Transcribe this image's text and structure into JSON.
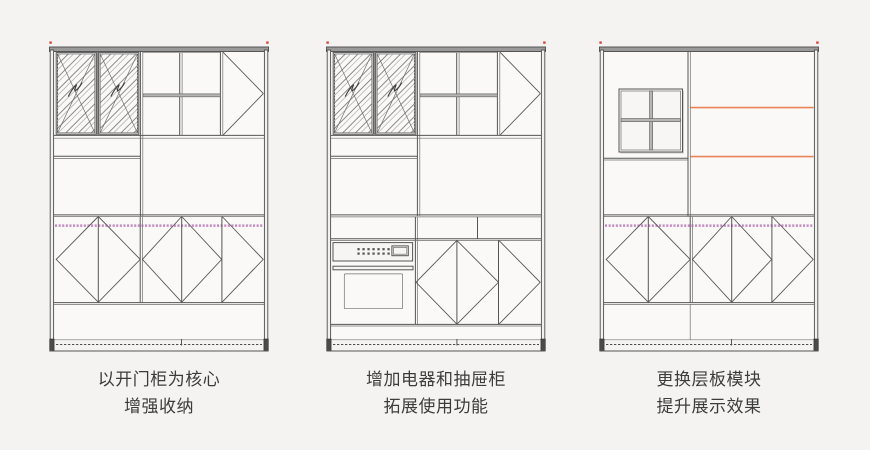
{
  "page": {
    "background_color": "#f4f3f1"
  },
  "colors": {
    "line": "#555555",
    "cap_fill": "#9a9a9a",
    "interior": "#faf9f7",
    "shelf_fill": "#b5b5b5",
    "accent_orange": "#e8835a",
    "accent_pink": "#c48bc4",
    "marker_red": "#d9453c",
    "caption_text": "#3c3c3c"
  },
  "figures": [
    {
      "name": "cabinet-open-door",
      "caption": {
        "line1": "以开门柜为核心",
        "line2": "增强收纳"
      }
    },
    {
      "name": "cabinet-appliance-drawer",
      "caption": {
        "line1": "增加电器和抽屉柜",
        "line2": "拓展使用功能"
      }
    },
    {
      "name": "cabinet-shelf-module",
      "caption": {
        "line1": "更换层板模块",
        "line2": "提升展示效果"
      }
    }
  ]
}
